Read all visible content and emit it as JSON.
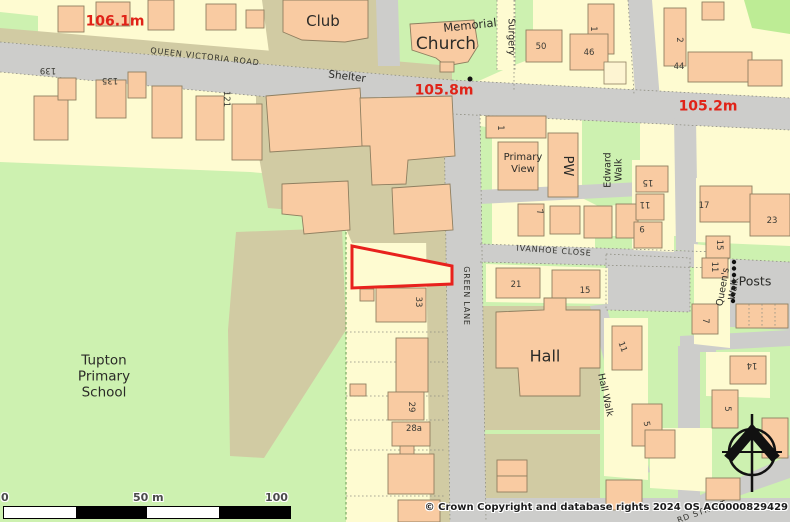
{
  "map": {
    "spot_heights": [
      {
        "label": "106.1m"
      },
      {
        "label": "105.8m"
      },
      {
        "label": "105.2m"
      }
    ],
    "roads": {
      "queen_victoria_road": "QUEEN VICTORIA ROAD",
      "green_lane": "GREEN LANE",
      "ivanhoe_close": "IVANHOE CLOSE",
      "edward_walk": "Edward\nWalk",
      "hall_walk": "Hall Walk",
      "queens_walk": "Queen's Walk",
      "surgery": "Surgery",
      "ward_street": "RD STREET"
    },
    "places": {
      "club": "Club",
      "memorial": "Memorial",
      "church": "Church",
      "shelter": "Shelter",
      "primary_view": "Primary\nView",
      "pw": "PW",
      "hall": "Hall",
      "school": "Tupton\nPrimary\nSchool",
      "posts": "Posts"
    },
    "house_numbers": [
      {
        "label": "139"
      },
      {
        "label": "135"
      },
      {
        "label": "121"
      },
      {
        "label": "1"
      },
      {
        "label": "50"
      },
      {
        "label": "46"
      },
      {
        "label": "2"
      },
      {
        "label": "44"
      },
      {
        "label": "1"
      },
      {
        "label": "7"
      },
      {
        "label": "15"
      },
      {
        "label": "11"
      },
      {
        "label": "9"
      },
      {
        "label": "17"
      },
      {
        "label": "23"
      },
      {
        "label": "15"
      },
      {
        "label": "11"
      },
      {
        "label": "7"
      },
      {
        "label": "21"
      },
      {
        "label": "15"
      },
      {
        "label": "33"
      },
      {
        "label": "29"
      },
      {
        "label": "28a"
      },
      {
        "label": "11"
      },
      {
        "label": "5"
      },
      {
        "label": "5"
      },
      {
        "label": "14"
      }
    ],
    "scale_bar": {
      "zero": "0",
      "fifty": "50 m",
      "hundred": "100 m"
    },
    "copyright": "© Crown Copyright and database rights 2024 OS AC0000829429",
    "colors": {
      "plot": "#FEFBD1",
      "grass": "#CDF1B0",
      "bright_grass": "#BDEC95",
      "road": "#CDCDCB",
      "made_ground": "#D1CBA3",
      "building": "#F9CBA2",
      "building_outline": "#8F7F60",
      "site_boundary": "#E8211D",
      "spot_height": "#E02318"
    }
  }
}
